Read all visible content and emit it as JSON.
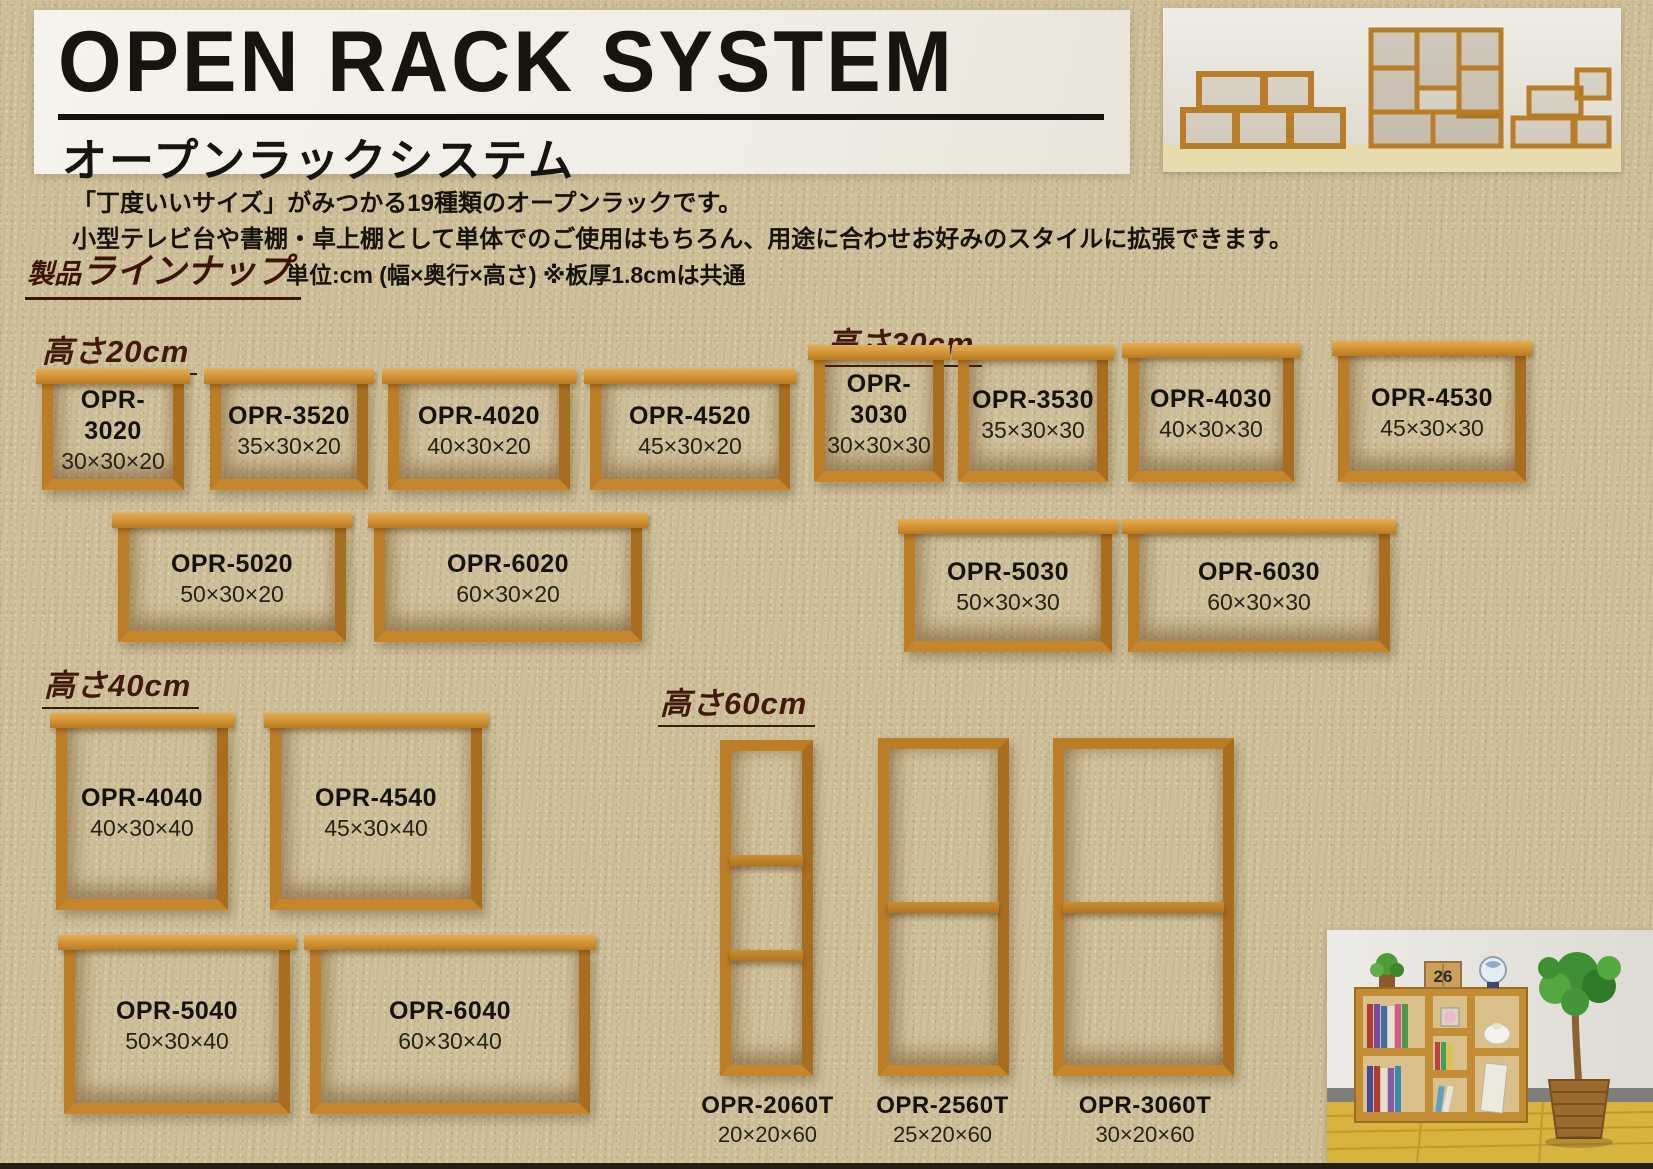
{
  "header": {
    "title": "OPEN RACK SYSTEM",
    "subtitle": "オープンラックシステム"
  },
  "intro": {
    "line1": "「丁度いいサイズ」がみつかる19種類のオープンラックです。",
    "line2": "小型テレビ台や書棚・卓上棚として単体でのご使用はもちろん、用途に合わせお好みのスタイルに拡張できます。"
  },
  "lineup": {
    "heading_prefix": "製品",
    "heading_main": "ラインナップ",
    "unit_note": "単位:cm (幅×奥行×高さ) ※板厚1.8cmは共通"
  },
  "sections": [
    {
      "heading": "高さ20cm",
      "products": [
        {
          "model": "OPR-3020",
          "size": "30×30×20"
        },
        {
          "model": "OPR-3520",
          "size": "35×30×20"
        },
        {
          "model": "OPR-4020",
          "size": "40×30×20"
        },
        {
          "model": "OPR-4520",
          "size": "45×30×20"
        },
        {
          "model": "OPR-5020",
          "size": "50×30×20"
        },
        {
          "model": "OPR-6020",
          "size": "60×30×20"
        }
      ]
    },
    {
      "heading": "高さ30cm",
      "products": [
        {
          "model": "OPR-3030",
          "size": "30×30×30"
        },
        {
          "model": "OPR-3530",
          "size": "35×30×30"
        },
        {
          "model": "OPR-4030",
          "size": "40×30×30"
        },
        {
          "model": "OPR-4530",
          "size": "45×30×30"
        },
        {
          "model": "OPR-5030",
          "size": "50×30×30"
        },
        {
          "model": "OPR-6030",
          "size": "60×30×30"
        }
      ]
    },
    {
      "heading": "高さ40cm",
      "products": [
        {
          "model": "OPR-4040",
          "size": "40×30×40"
        },
        {
          "model": "OPR-4540",
          "size": "45×30×40"
        },
        {
          "model": "OPR-5040",
          "size": "50×30×40"
        },
        {
          "model": "OPR-6040",
          "size": "60×30×40"
        }
      ]
    },
    {
      "heading": "高さ60cm",
      "products": [
        {
          "model": "OPR-2060T",
          "size": "20×20×60"
        },
        {
          "model": "OPR-2560T",
          "size": "25×20×60"
        },
        {
          "model": "OPR-3060T",
          "size": "30×20×60"
        }
      ]
    }
  ],
  "photos": {
    "calendar_day": "26"
  },
  "colors": {
    "page_background": "#cec09a",
    "banner_background": "#f3f0e9",
    "wood_frame": "#bc7d27",
    "wood_top": "#d69a3f",
    "heading_text": "#42190d",
    "body_text": "#17130c"
  }
}
